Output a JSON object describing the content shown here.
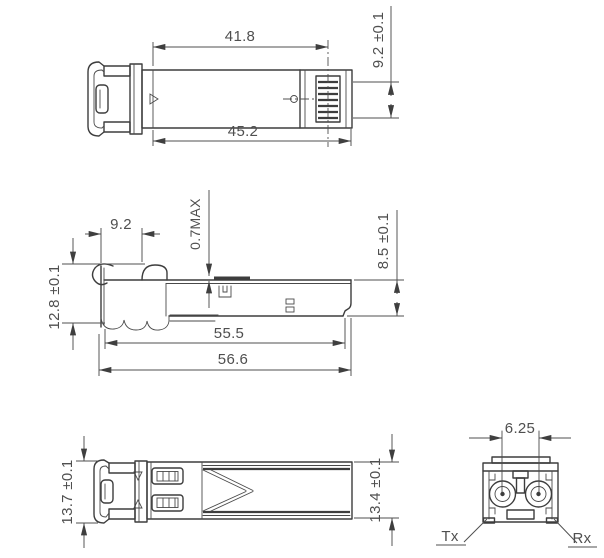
{
  "drawing": {
    "type": "mechanical-engineering-drawing",
    "subject": "SFP optical transceiver module - dimensioned orthographic views",
    "colors": {
      "line": "#3d3d3d",
      "dim": "#4f4f4f",
      "text": "#4f4f4f",
      "background": "#ffffff"
    },
    "views": {
      "top": {
        "dims": {
          "body_length": "41.8",
          "overall_length": "45.2",
          "end_width": "9.2 ±0.1"
        }
      },
      "side": {
        "dims": {
          "nose_length": "9.2",
          "tab_protrusion": "0.7MAX",
          "front_height": "12.8 ±0.1",
          "body_height": "8.5 ±0.1",
          "housing_length": "55.5",
          "overall_length": "56.6"
        }
      },
      "bottom": {
        "dims": {
          "overall_width": "13.7 ±0.1",
          "body_width": "13.4 ±0.1"
        }
      },
      "front": {
        "dims": {
          "fiber_pitch": "6.25"
        },
        "labels": {
          "tx": "Tx",
          "rx": "Rx"
        }
      }
    }
  }
}
